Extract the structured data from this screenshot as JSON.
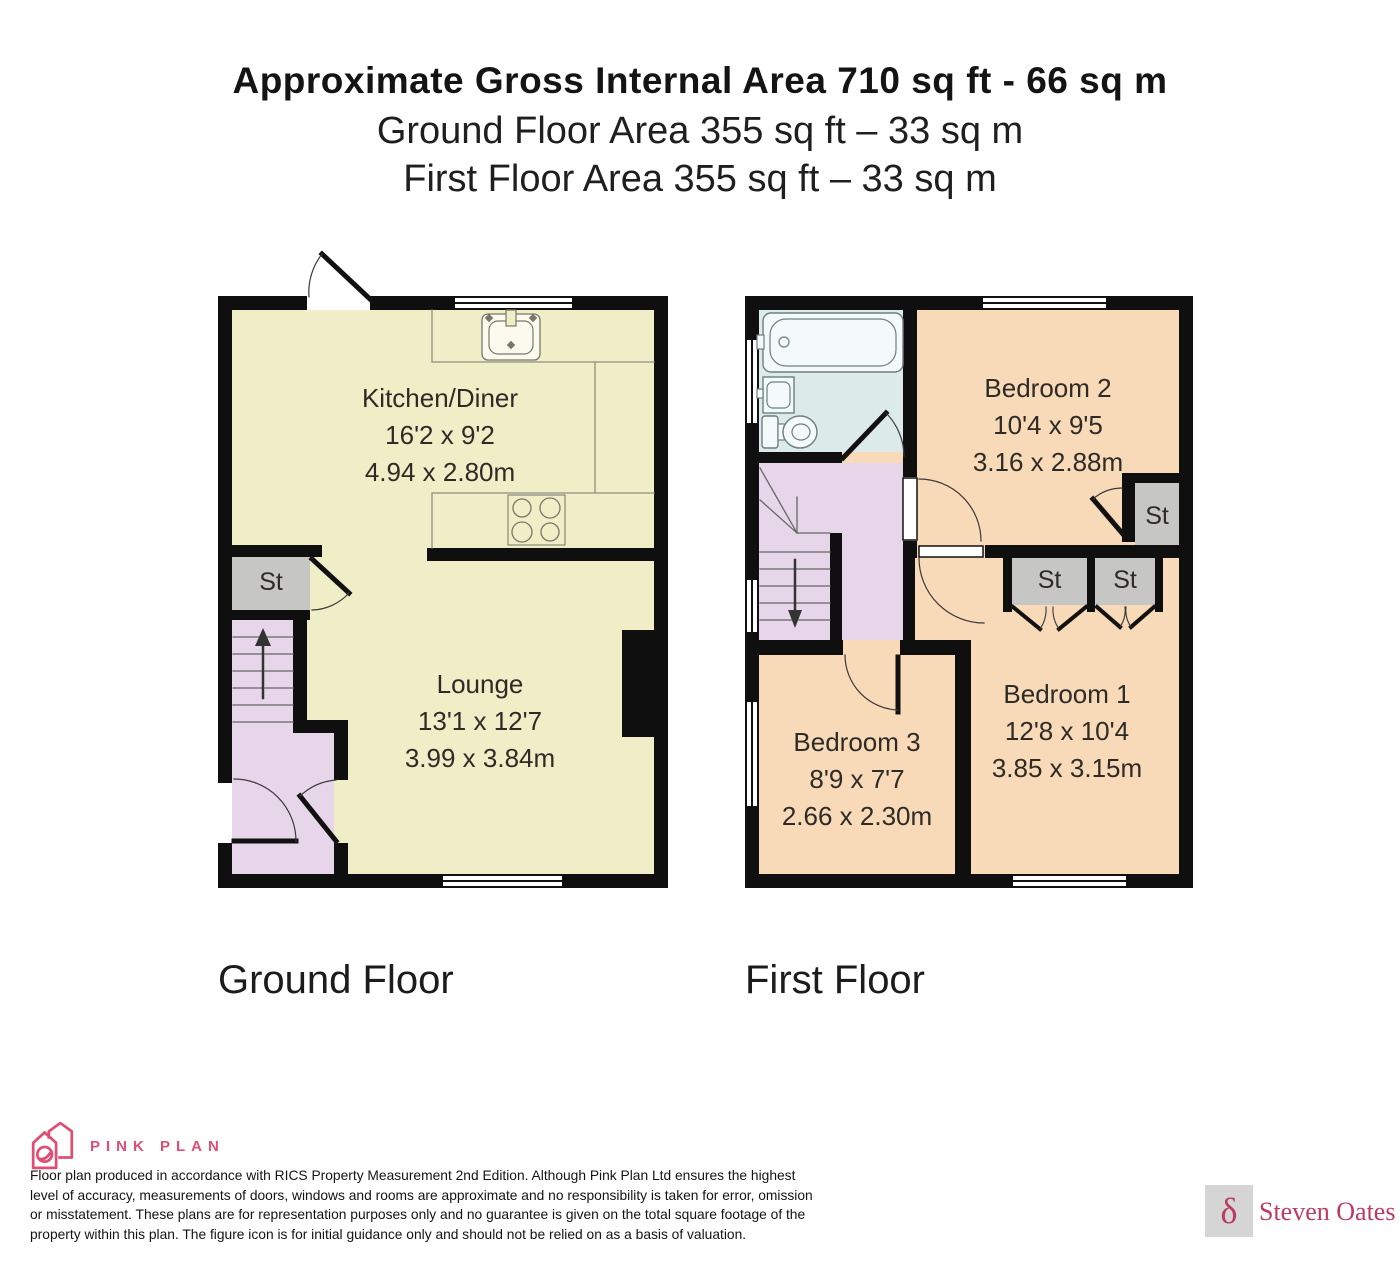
{
  "header": {
    "title": "Approximate Gross Internal Area 710 sq ft - 66 sq m",
    "subtitle_ground": "Ground Floor Area 355 sq ft – 33 sq m",
    "subtitle_first": "First Floor Area 355 sq ft – 33 sq m"
  },
  "ground_floor": {
    "label": "Ground Floor",
    "rooms": {
      "kitchen": {
        "name": "Kitchen/Diner",
        "imperial": "16'2 x 9'2",
        "metric": "4.94 x 2.80m"
      },
      "lounge": {
        "name": "Lounge",
        "imperial": "13'1 x 12'7",
        "metric": "3.99 x 3.84m"
      },
      "store": {
        "name": "St"
      }
    }
  },
  "first_floor": {
    "label": "First Floor",
    "rooms": {
      "bedroom2": {
        "name": "Bedroom 2",
        "imperial": "10'4 x 9'5",
        "metric": "3.16 x 2.88m"
      },
      "bedroom1": {
        "name": "Bedroom 1",
        "imperial": "12'8 x 10'4",
        "metric": "3.85 x 3.15m"
      },
      "bedroom3": {
        "name": "Bedroom 3",
        "imperial": "8'9 x 7'7",
        "metric": "2.66 x 2.30m"
      },
      "store_bedroom2": {
        "name": "St"
      },
      "store_landing_left": {
        "name": "St"
      },
      "store_landing_right": {
        "name": "St"
      }
    }
  },
  "footer": {
    "brand": "PINK PLAN",
    "disclaimer_lines": [
      "Floor plan produced in accordance with RICS Property Measurement 2nd Edition. Although Pink Plan Ltd ensures the highest",
      "level of accuracy, measurements of doors, windows and rooms are approximate and no responsibility is taken for error, omission",
      "or misstatement. These plans are for representation purposes only and no guarantee is given on the total square footage of the",
      "property within this plan. The figure icon is for initial guidance only and should not be relied on as a basis of valuation."
    ],
    "agent": {
      "symbol": "δ",
      "name": "Steven Oates"
    }
  },
  "colors": {
    "wall": "#0f0f0f",
    "room_yellow": "#f0eec7",
    "room_peach": "#f8d9b8",
    "hall_lavender": "#e7d6e9",
    "bath_blue": "#dcebe9",
    "store_gray": "#c6c6c4",
    "brand_pink": "#e04e72",
    "agent_crimson": "#bd3a60"
  }
}
